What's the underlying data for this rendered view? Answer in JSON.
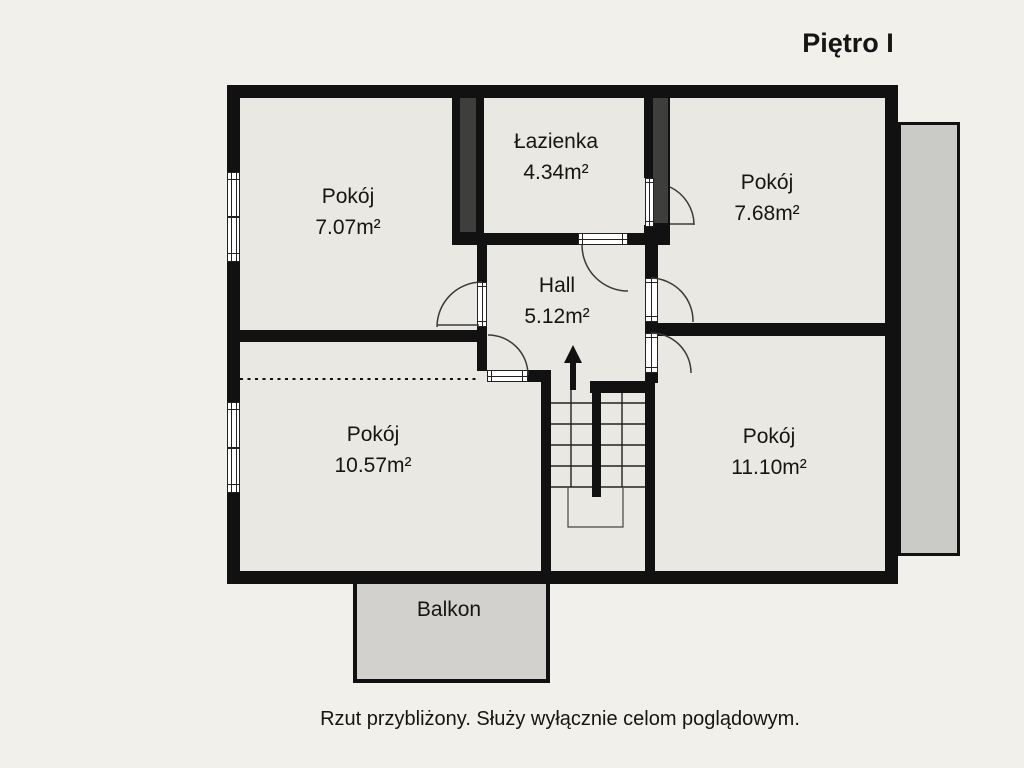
{
  "title": "Piętro I",
  "caption": "Rzut przybliżony. Służy wyłącznie celom poglądowym.",
  "rooms": [
    {
      "name": "Pokój",
      "area": "7.07m²"
    },
    {
      "name": "Łazienka",
      "area": "4.34m²"
    },
    {
      "name": "Pokój",
      "area": "7.68m²"
    },
    {
      "name": "Hall",
      "area": "5.12m²"
    },
    {
      "name": "Pokój",
      "area": "10.57m²"
    },
    {
      "name": "Pokój",
      "area": "11.10m²"
    }
  ],
  "balcony": {
    "label": "Balkon"
  },
  "colors": {
    "background": "#f1f0ea",
    "interior": "#e9e8e2",
    "wall": "#111111",
    "shaft": "#3e3e3c",
    "balcony": "#d2d1cd",
    "terrace": "#cacac6",
    "line": "#3a3a3a",
    "text": "#151515"
  }
}
